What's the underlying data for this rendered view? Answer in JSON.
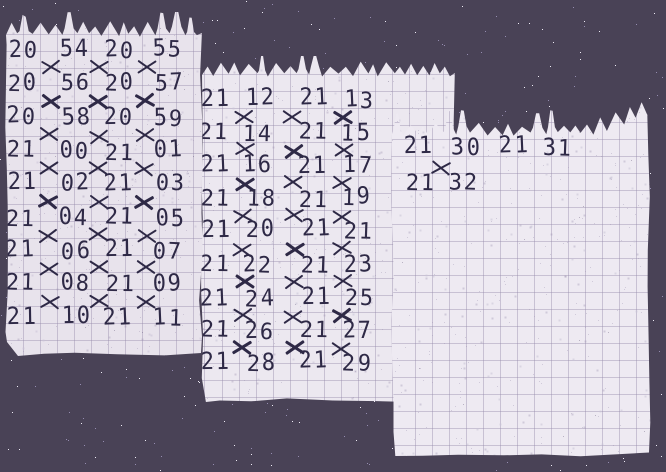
{
  "scene": {
    "background_color": "#494256",
    "star_bright_color": "#efecf6",
    "star_dim_color": "#958cb0",
    "paper_left_color": "#e8e3ec",
    "paper_middle_color": "#ece8f0",
    "paper_right_color": "#eeeaf2",
    "grid_color": "#b4abc6",
    "ink_color": "#2e2946"
  },
  "notes": [
    {
      "id": "note-left",
      "rows": [
        [
          "20",
          "54",
          "20",
          "55"
        ],
        [
          "20",
          "56",
          "20",
          "57"
        ],
        [
          "20",
          "58",
          "20",
          "59"
        ],
        [
          "21",
          "00",
          "21",
          "01"
        ],
        [
          "21",
          "02",
          "21",
          "03"
        ],
        [
          "21",
          "04",
          "21",
          "05"
        ],
        [
          "21",
          "06",
          "21",
          "07"
        ],
        [
          "21",
          "08",
          "21",
          "09"
        ],
        [
          "21",
          "10",
          "21",
          "11"
        ]
      ],
      "x_marks_between_rows": [
        [
          0,
          1,
          2
        ],
        [
          0,
          1,
          2
        ],
        [
          0,
          1,
          2
        ],
        [
          0,
          1,
          2
        ],
        [
          0,
          1,
          2
        ],
        [
          0,
          1,
          2
        ],
        [
          0,
          1,
          2
        ],
        [
          0,
          1,
          2
        ]
      ]
    },
    {
      "id": "note-middle",
      "rows": [
        [
          "21",
          "12",
          "21",
          "13"
        ],
        [
          "21",
          "14",
          "21",
          "15"
        ],
        [
          "21",
          "16",
          "21",
          "17"
        ],
        [
          "21",
          "18",
          "21",
          "19"
        ],
        [
          "21",
          "20",
          "21",
          "21"
        ],
        [
          "21",
          "22",
          "21",
          "23"
        ],
        [
          "21",
          "24",
          "21",
          "25"
        ],
        [
          "21",
          "26",
          "21",
          "27"
        ],
        [
          "21",
          "28",
          "21",
          "29"
        ]
      ],
      "x_marks_between_rows": [
        [
          0,
          1,
          2
        ],
        [
          0,
          1,
          2
        ],
        [
          0,
          1,
          2
        ],
        [
          0,
          1,
          2
        ],
        [
          0,
          1,
          2
        ],
        [
          0,
          1,
          2
        ],
        [
          0,
          1,
          2
        ],
        [
          0,
          1,
          2
        ]
      ]
    },
    {
      "id": "note-right",
      "rows": [
        [
          "21",
          "30",
          "21",
          "31"
        ],
        [
          "21",
          "32"
        ]
      ],
      "x_marks_between_rows": [
        [
          0
        ]
      ]
    }
  ]
}
